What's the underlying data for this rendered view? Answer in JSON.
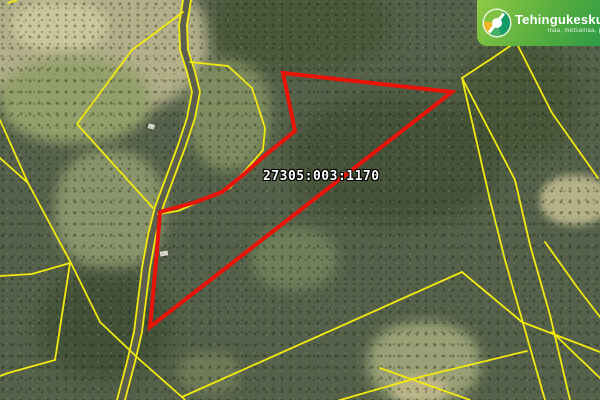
{
  "map": {
    "parcel_label": "27305:003:1170",
    "highlight_color": "#e81309",
    "cadastral_line_color": "#f2ea0f",
    "road_surface_color": "#5d5f4e",
    "red_parcel_points": "283,73 452,92 150,327 153,295 157,250 160,212 196,202 222,192 243,175 263,157 295,131",
    "road_casing_points": "187,0 183,25 184,50 191,72 196,92 191,118 181,148 169,180 159,207 152,235 146,268 142,300 138,332 131,362 121,400",
    "yellow_lines": [
      "183,0 179,25 180,50 187,72 192,92 187,118 177,148 165,180 155,207 148,235 142,268 138,300 134,332 127,362 117,400",
      "191,0 187,25 188,50 195,72 200,92 195,118 185,148 173,180 163,207 156,235 150,268 146,300 142,332 135,362 125,400",
      "190,62 228,66 252,88 265,128 263,150 230,188 178,211 158,214",
      "132,50 183,12",
      "132,50 77,124 153,208",
      "0,120 28,183 0,158",
      "28,183 72,265 100,322 140,360 182,397 185,400",
      "182,397 462,272 522,322 600,352",
      "330,403 420,377 527,351",
      "380,368 470,400",
      "8,3 17,0",
      "0,276 32,274 70,263",
      "70,263 55,360 8,373 0,376",
      "462,78 497,55 545,22",
      "462,78 490,200 505,260 525,330 545,400",
      "462,78 515,180 530,245 550,315 570,400",
      "515,40 552,113 598,178",
      "545,242 577,287 600,317",
      "552,332 600,378"
    ]
  },
  "logo": {
    "name": "Tehingukeskus",
    "tagline": "maa, metsamaa, põld",
    "banner_color_light": "#90cb45",
    "banner_color_dark": "#2e9c45"
  }
}
